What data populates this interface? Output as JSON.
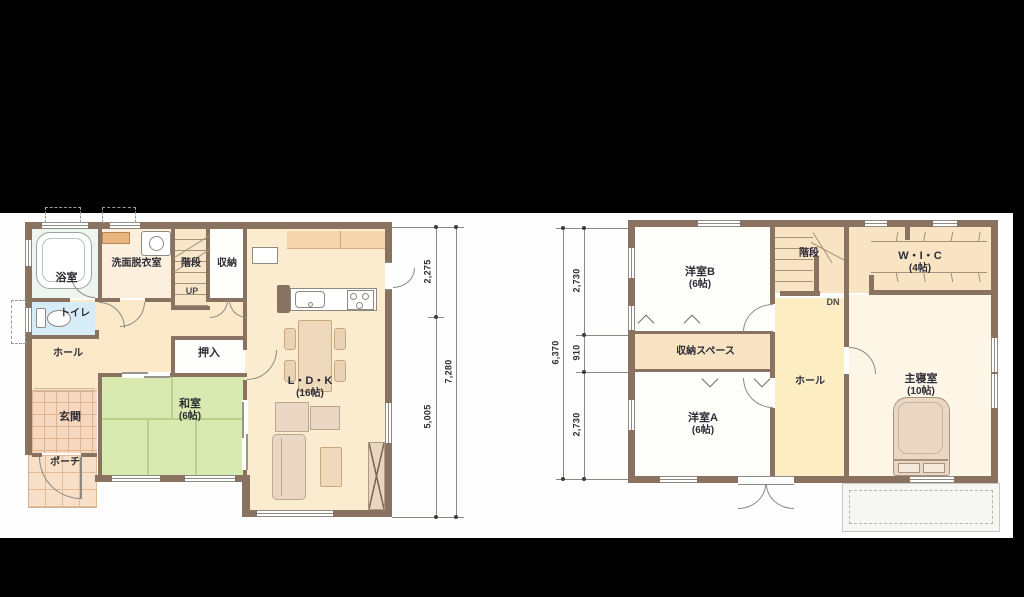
{
  "document": {
    "type": "floor-plan",
    "background": "#000000",
    "paper": "#fefefe"
  },
  "floor1": {
    "bath": "浴室",
    "washroom": "洗面脱衣室",
    "stairs": "階段",
    "storage": "収納",
    "up": "UP",
    "toilet": "トイレ",
    "hall": "ホール",
    "oshiire": "押入",
    "genkan": "玄関",
    "porch": "ポーチ",
    "washitsu": {
      "name": "和室",
      "size": "(6帖)"
    },
    "ldk": {
      "name": "L・D・K",
      "size": "(16帖)"
    },
    "dims": {
      "seg1": "2,275",
      "seg2": "5,005",
      "total": "7,280"
    }
  },
  "floor2": {
    "bedroomB": {
      "name": "洋室B",
      "size": "(6帖)"
    },
    "stairs": "階段",
    "dn": "DN",
    "wic": {
      "name": "W・I・C",
      "size": "(4帖)"
    },
    "storageSpace": "収納スペース",
    "hall": "ホール",
    "bedroomA": {
      "name": "洋室A",
      "size": "(6帖)"
    },
    "master": {
      "name": "主寝室",
      "size": "(10帖)"
    },
    "dims": {
      "total": "6,370",
      "seg1": "2,730",
      "seg2": "910",
      "seg3": "2,730"
    }
  },
  "colors": {
    "wall": "#8a7260",
    "ldk_floor": "#fbecd0",
    "hall_floor": "#fbe9c9",
    "tatami": "#d9eab0",
    "toilet_floor": "#d6ecf6",
    "bath_floor": "#edf5ee",
    "tile_floor": "#f6d8c0",
    "closet_floor": "#f8e3c2",
    "hall2_floor": "#fcedc2",
    "master_floor": "#fdf6e6",
    "furniture": "#ead7c3",
    "dimension_line": "#8d8a84"
  }
}
